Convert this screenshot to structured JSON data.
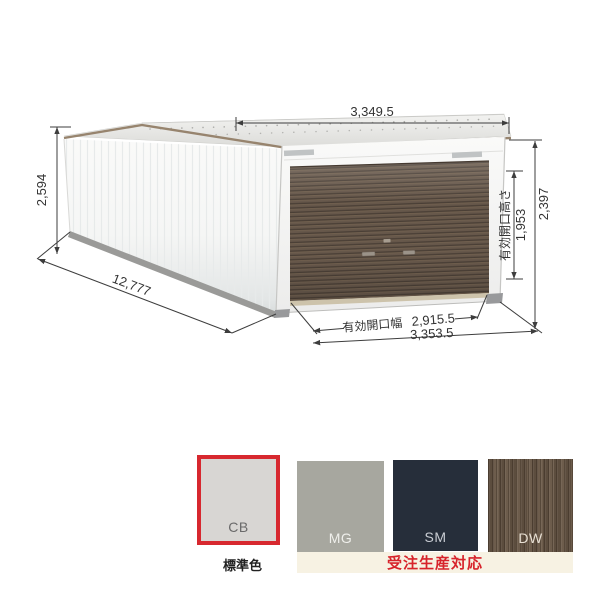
{
  "product_drawing": {
    "dimensions": {
      "roof_width": "3,349.5",
      "body_height": "2,594",
      "depth": "12,777",
      "opening_width_label": "有効開口幅",
      "opening_width": "2,915.5",
      "overall_width": "3,353.5",
      "overall_height": "2,397",
      "opening_height_label": "有効開口高さ",
      "opening_height": "1,953"
    }
  },
  "color_options": {
    "swatches": [
      {
        "code": "CB",
        "hex": "#d8d6d3",
        "label_color": "#6a6a6a",
        "selected": true
      },
      {
        "code": "MG",
        "hex": "#a7a79f",
        "label_color": "#efefeb",
        "selected": false
      },
      {
        "code": "SM",
        "hex": "#262e3a",
        "label_color": "#c9cdd3",
        "selected": false
      },
      {
        "code": "DW",
        "hex": "#675645",
        "label_color": "#e8e0d4",
        "selected": false,
        "texture": "wood"
      }
    ],
    "standard_color_label": "標準色",
    "made_to_order_label": "受注生産対応",
    "selected_border_color": "#d7282f",
    "made_to_order_text_color": "#d7232b",
    "made_to_order_bg": "#f7f2e3"
  }
}
